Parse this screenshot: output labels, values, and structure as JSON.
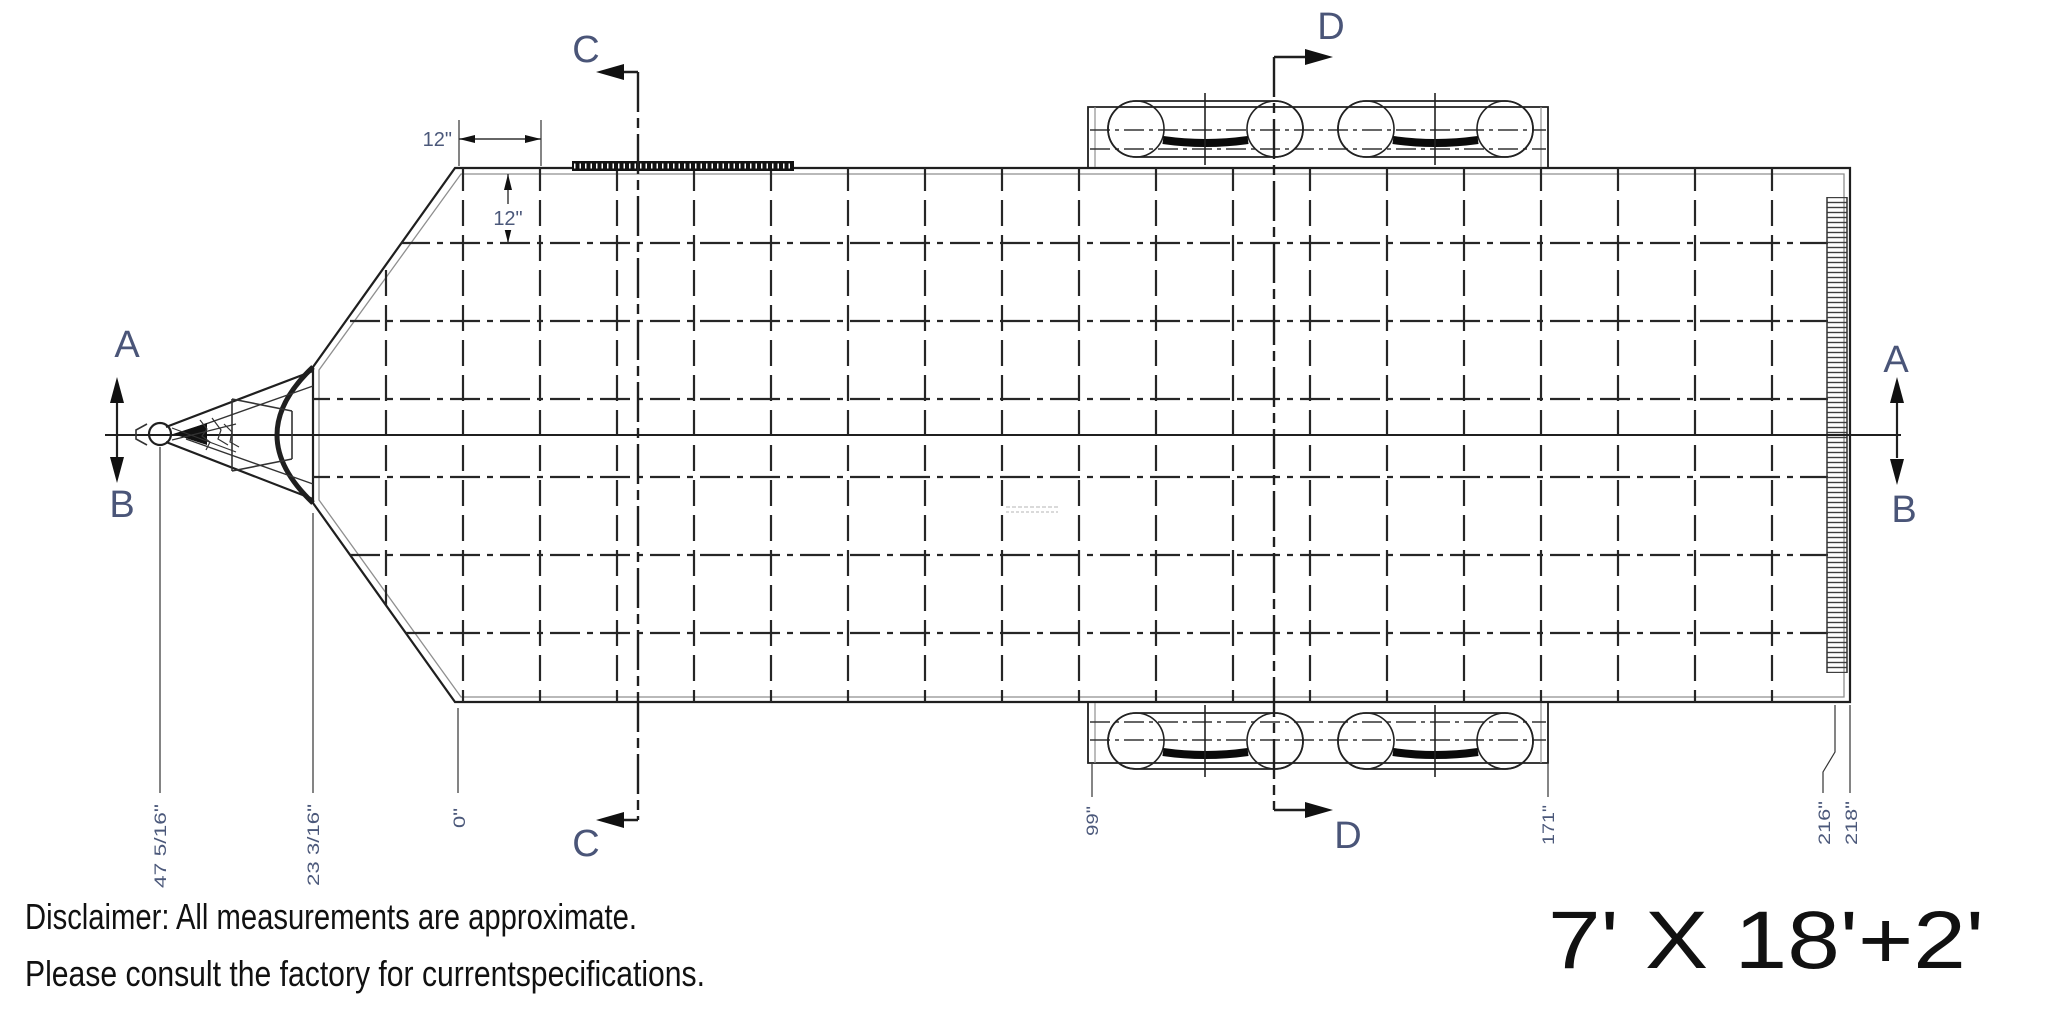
{
  "drawing": {
    "section_labels": {
      "a": "A",
      "b": "B",
      "c": "C",
      "d": "D"
    },
    "dimensions": {
      "twelve": "12\"",
      "coupler": "47 5/16\"",
      "nose": "23 3/16\"",
      "deck_front": "0\"",
      "axle_front": "99\"",
      "axle_rear": "171\"",
      "deck_rear": "216\"",
      "overall": "218\""
    },
    "colors": {
      "line": "#1f1f1f",
      "edge_gray": "#8f8f8f",
      "marker_text": "#4a5578",
      "dimension_text": "#4b587a",
      "footer_text": "#111111"
    }
  },
  "footer": {
    "disclaimer_line1": "Disclaimer: All measurements are approximate.",
    "disclaimer_line2": "Please consult the factory for currentspecifications.",
    "model_size": "7' X 18'+2'"
  }
}
